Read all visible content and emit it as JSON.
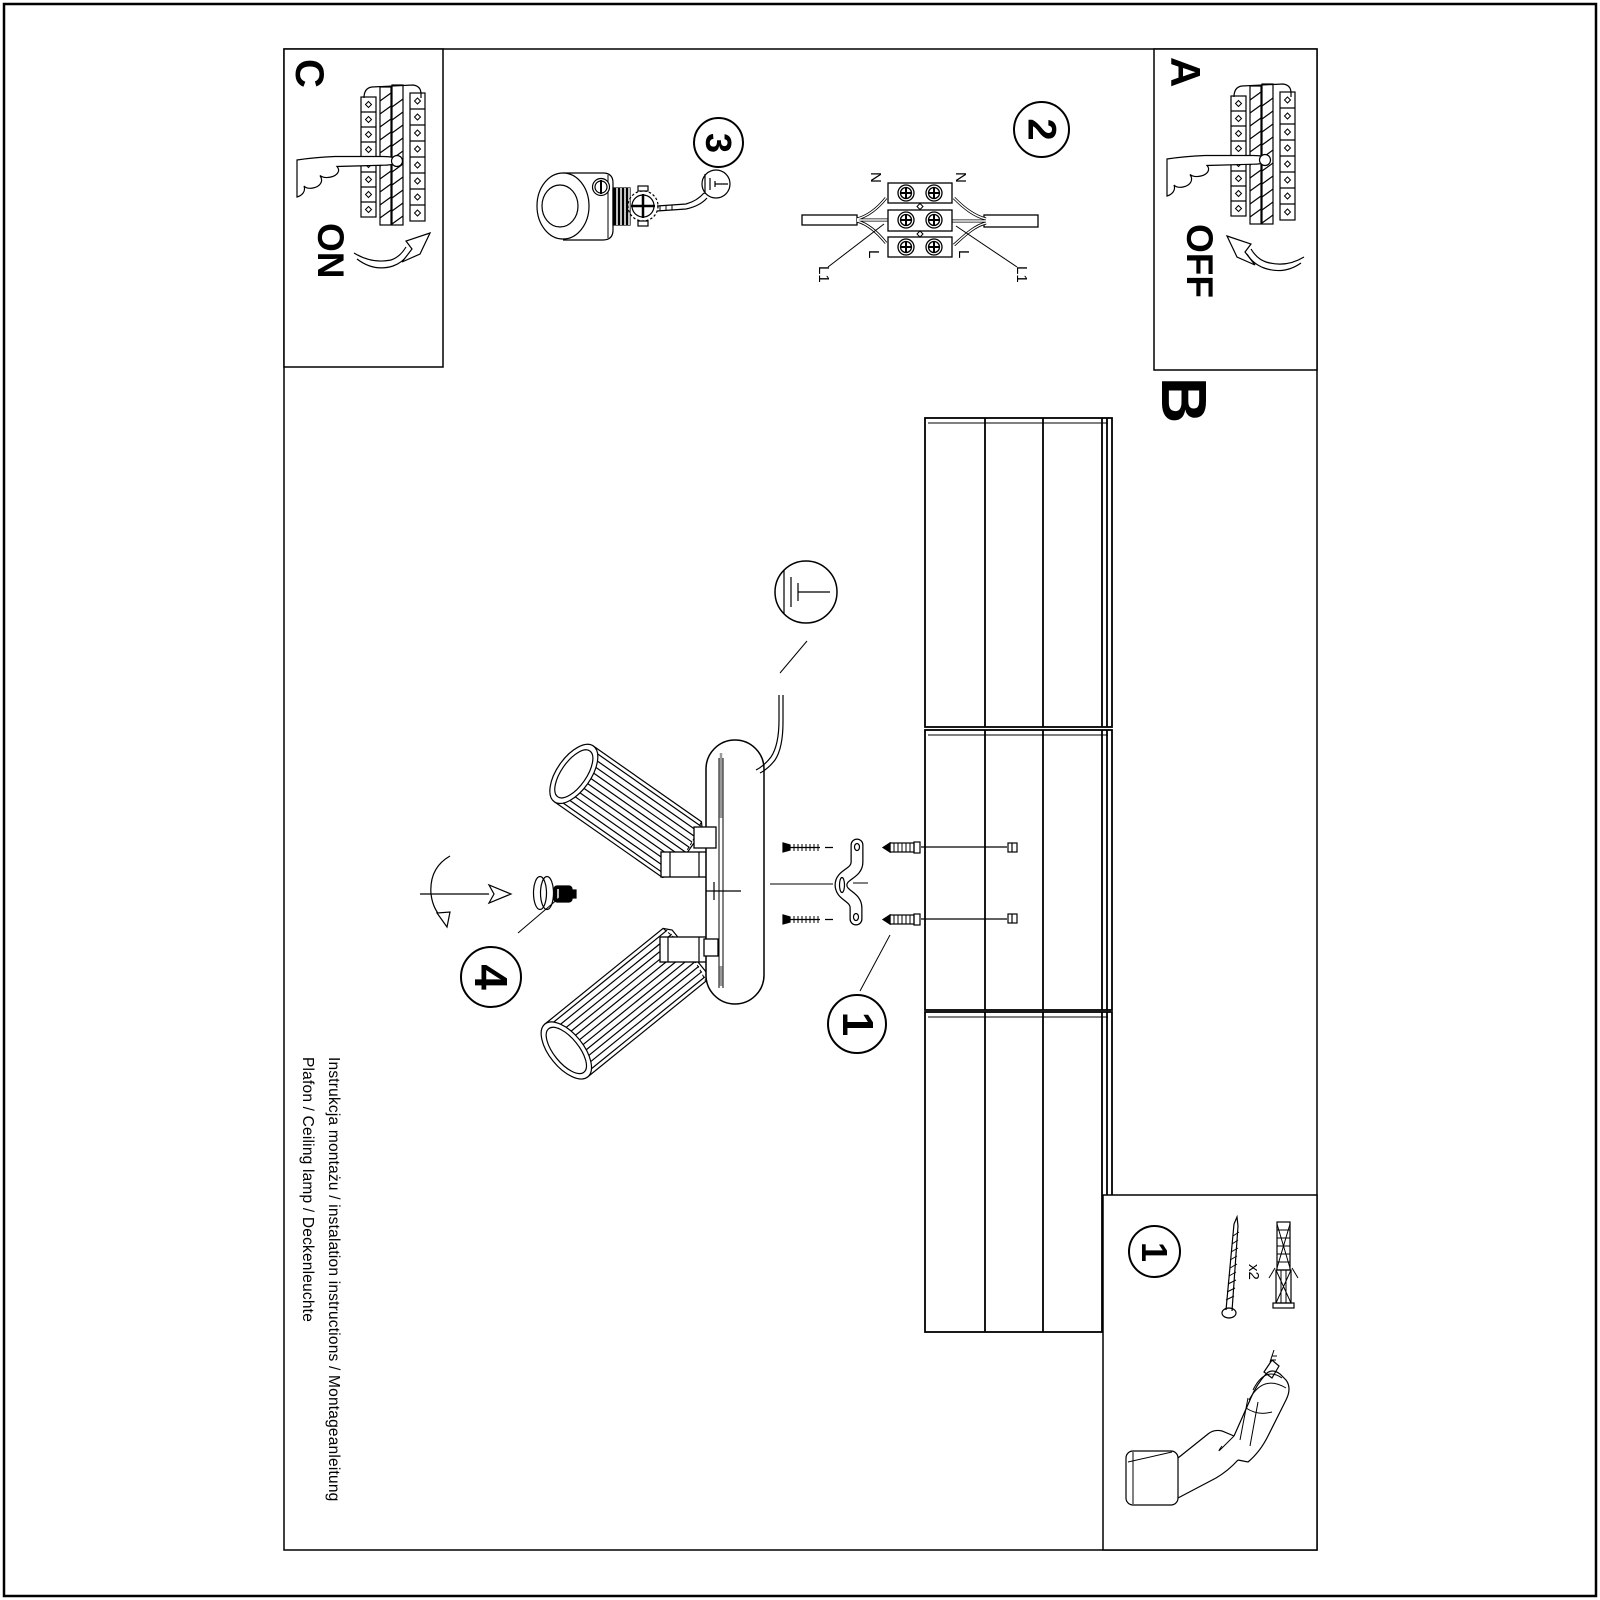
{
  "panel_a": {
    "label": "A",
    "switch_state": "OFF"
  },
  "panel_b": {
    "label": "B"
  },
  "panel_c": {
    "label": "C",
    "switch_state": "ON"
  },
  "step_circles": {
    "mount": "1",
    "wiring": "2",
    "ground": "3",
    "shade_fix": "4"
  },
  "parts_box": {
    "step": "1",
    "screws_qty": "x2"
  },
  "terminal_labels": {
    "neutral_left": "N",
    "neutral_right": "N",
    "live_left": "L",
    "live_right": "L",
    "l1_left": "L1",
    "l1_right": "L1"
  },
  "footer": {
    "line1": "Instrukcja montażu / instalation instructions / Montageanleitung",
    "line2": "Plafon / Ceiling lamp / Deckenleuchte"
  },
  "colors": {
    "ink": "#000000",
    "paper": "#ffffff",
    "accent_gray": "#999999"
  }
}
